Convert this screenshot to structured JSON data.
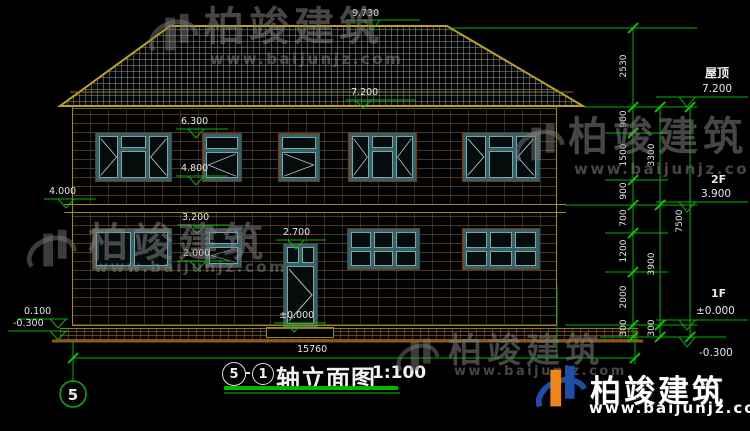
{
  "watermark": {
    "brand": "柏竣建筑",
    "url": "www.baijunjz.com"
  },
  "drawing": {
    "title": {
      "axis_start": "5",
      "separator": "-",
      "axis_end": "1",
      "name": "轴立面图",
      "scale": "1:100"
    },
    "axis_bubble_label": "5",
    "total_width": "15760",
    "colors": {
      "dimension_green": "#00b400",
      "cad_yellow": "#b8a21e",
      "frame_teal": "#3c6b72",
      "ground_brown": "#8a5a14"
    },
    "elevation_marks": {
      "ridge": "9.730",
      "eave": "7.200",
      "w2_top": "6.300",
      "w2_sill": "4.800",
      "belt_left": "4.000",
      "w1_top": "3.200",
      "w1_sill": "2.000",
      "door_top": "2.700",
      "floor_zero": "±0.000",
      "plinth_top": "0.100",
      "ground": "-0.300"
    },
    "levels_right": {
      "roof_label": "屋顶",
      "roof_value": "7.200",
      "f2_label": "2F",
      "f2_value": "3.900",
      "f1_label": "1F",
      "f1_value": "±0.000",
      "below_ground": "-0.300"
    },
    "dim_columns": {
      "col1": [
        "2530",
        "900",
        "1500",
        "900",
        "700",
        "1200",
        "2000",
        "300"
      ],
      "col2": [
        "3300",
        "3900",
        "300"
      ],
      "col3": [
        "7500"
      ]
    }
  }
}
